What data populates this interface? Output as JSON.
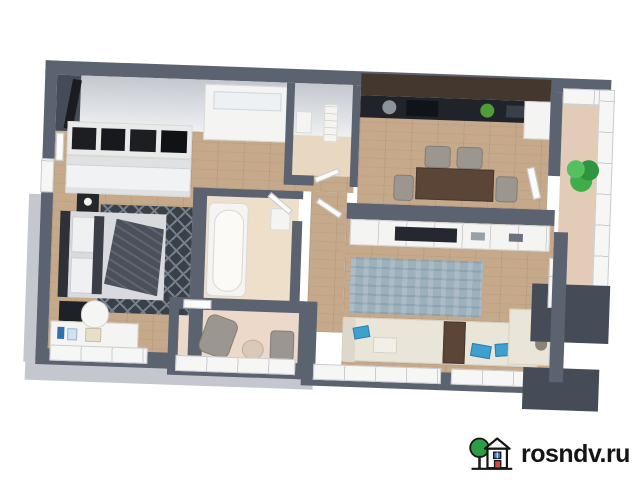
{
  "watermark": {
    "text": "rosndv.ru",
    "logo": "tree-house-icon",
    "text_color": "#151515",
    "tree_color": "#2d9c45",
    "house_window_color": "#3b7fd4",
    "house_door_color": "#d1493f",
    "outline_color": "#161616"
  },
  "palette": {
    "wall": "#5b6270",
    "wall_dark": "#454b57",
    "wall_face": "#eef0f2",
    "wall_face_shadow": "#c4c8ce",
    "wood": "#c6a98a",
    "tile_bath": "#eddfc9",
    "tile_wc": "#e9d8c1",
    "balcony_floor": "#ecd9ca",
    "balcony_right_floor": "#e2ccb7",
    "white_furniture": "#f4f4f2",
    "rug_dark": "#394048",
    "rug_lattice": "#76808c",
    "rug_blue": "#9db1bd",
    "sofa_cream": "#eae5d9",
    "pillow_blue": "#3da0cf",
    "kitchen_cabinet": "#44372e",
    "kitchen_counter": "#20242a",
    "dining_table": "#5a4537",
    "chair_gray": "#9b968f",
    "bed_headboard": "#2e3238",
    "bedding": "#d9dadd",
    "blanket": "#4b505a",
    "plant_green": "#3fae4a",
    "tv_black": "#25282e"
  },
  "floorplan": {
    "view": "3d-top-down-apartment-render",
    "rooms": [
      {
        "name": "hallway",
        "floor": "wood",
        "furniture": [
          "open-wardrobe",
          "dresser",
          "console-cabinet",
          "coat-rack"
        ]
      },
      {
        "name": "bedroom",
        "floor": "wood",
        "furniture": [
          "double-bed",
          "dark-patterned-rug",
          "nightstand",
          "bench",
          "vanity-desk",
          "desk-chair",
          "cosmetics"
        ]
      },
      {
        "name": "bathroom",
        "floor": "beige-tile",
        "furniture": [
          "bathtub",
          "cabinet"
        ]
      },
      {
        "name": "wc",
        "floor": "beige-tile",
        "furniture": [
          "radiator",
          "washbasin"
        ]
      },
      {
        "name": "kitchen-dining",
        "floor": "wood",
        "furniture": [
          "dark-kitchen-cabinets",
          "black-countertop",
          "sink",
          "cooktop",
          "green-plate",
          "fridge",
          "dining-table",
          "four-gray-chairs"
        ]
      },
      {
        "name": "living-room",
        "floor": "wood",
        "furniture": [
          "white-shelving-with-tv",
          "blue-gray-rug",
          "corner-sofa",
          "blue-pillows",
          "wooden-side-table"
        ]
      },
      {
        "name": "loggia-bottom",
        "floor": "beige",
        "furniture": [
          "lounge-chair",
          "pouf",
          "small-bench"
        ]
      },
      {
        "name": "loggia-right",
        "floor": "beige",
        "furniture": [
          "potted-plant"
        ]
      }
    ]
  }
}
